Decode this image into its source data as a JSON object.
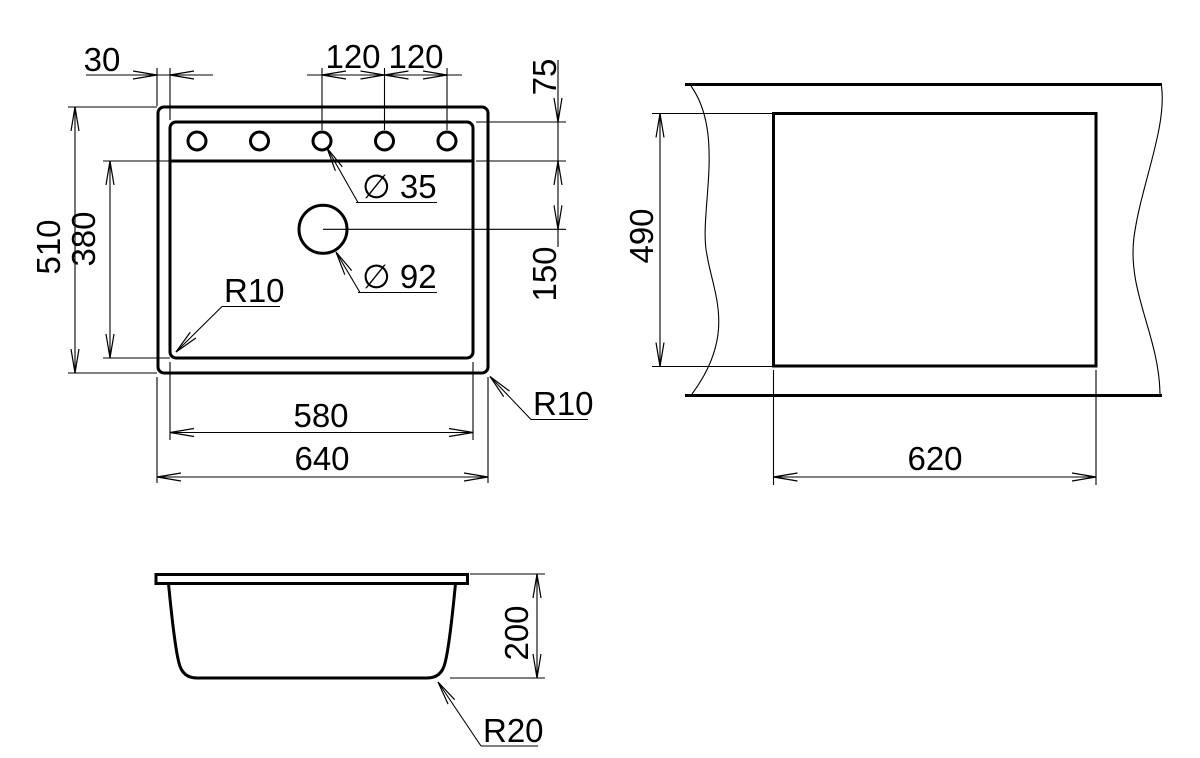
{
  "drawing_type": "dimensioned technical drawing, 3 orthographic views of a kitchen sink",
  "colors": {
    "line": "#000000",
    "background": "#ffffff"
  },
  "labels": {
    "top": {
      "d30": "30",
      "d120a": "120",
      "d120b": "120",
      "d75": "75",
      "d510": "510",
      "d380": "380",
      "d150": "150",
      "dia35": "∅ 35",
      "dia92": "∅ 92",
      "r10_inner": "R10",
      "r10_outer": "R10",
      "d580": "580",
      "d640": "640"
    },
    "cutout": {
      "d490": "490",
      "d620": "620"
    },
    "front": {
      "d200": "200",
      "r20": "R20"
    }
  }
}
